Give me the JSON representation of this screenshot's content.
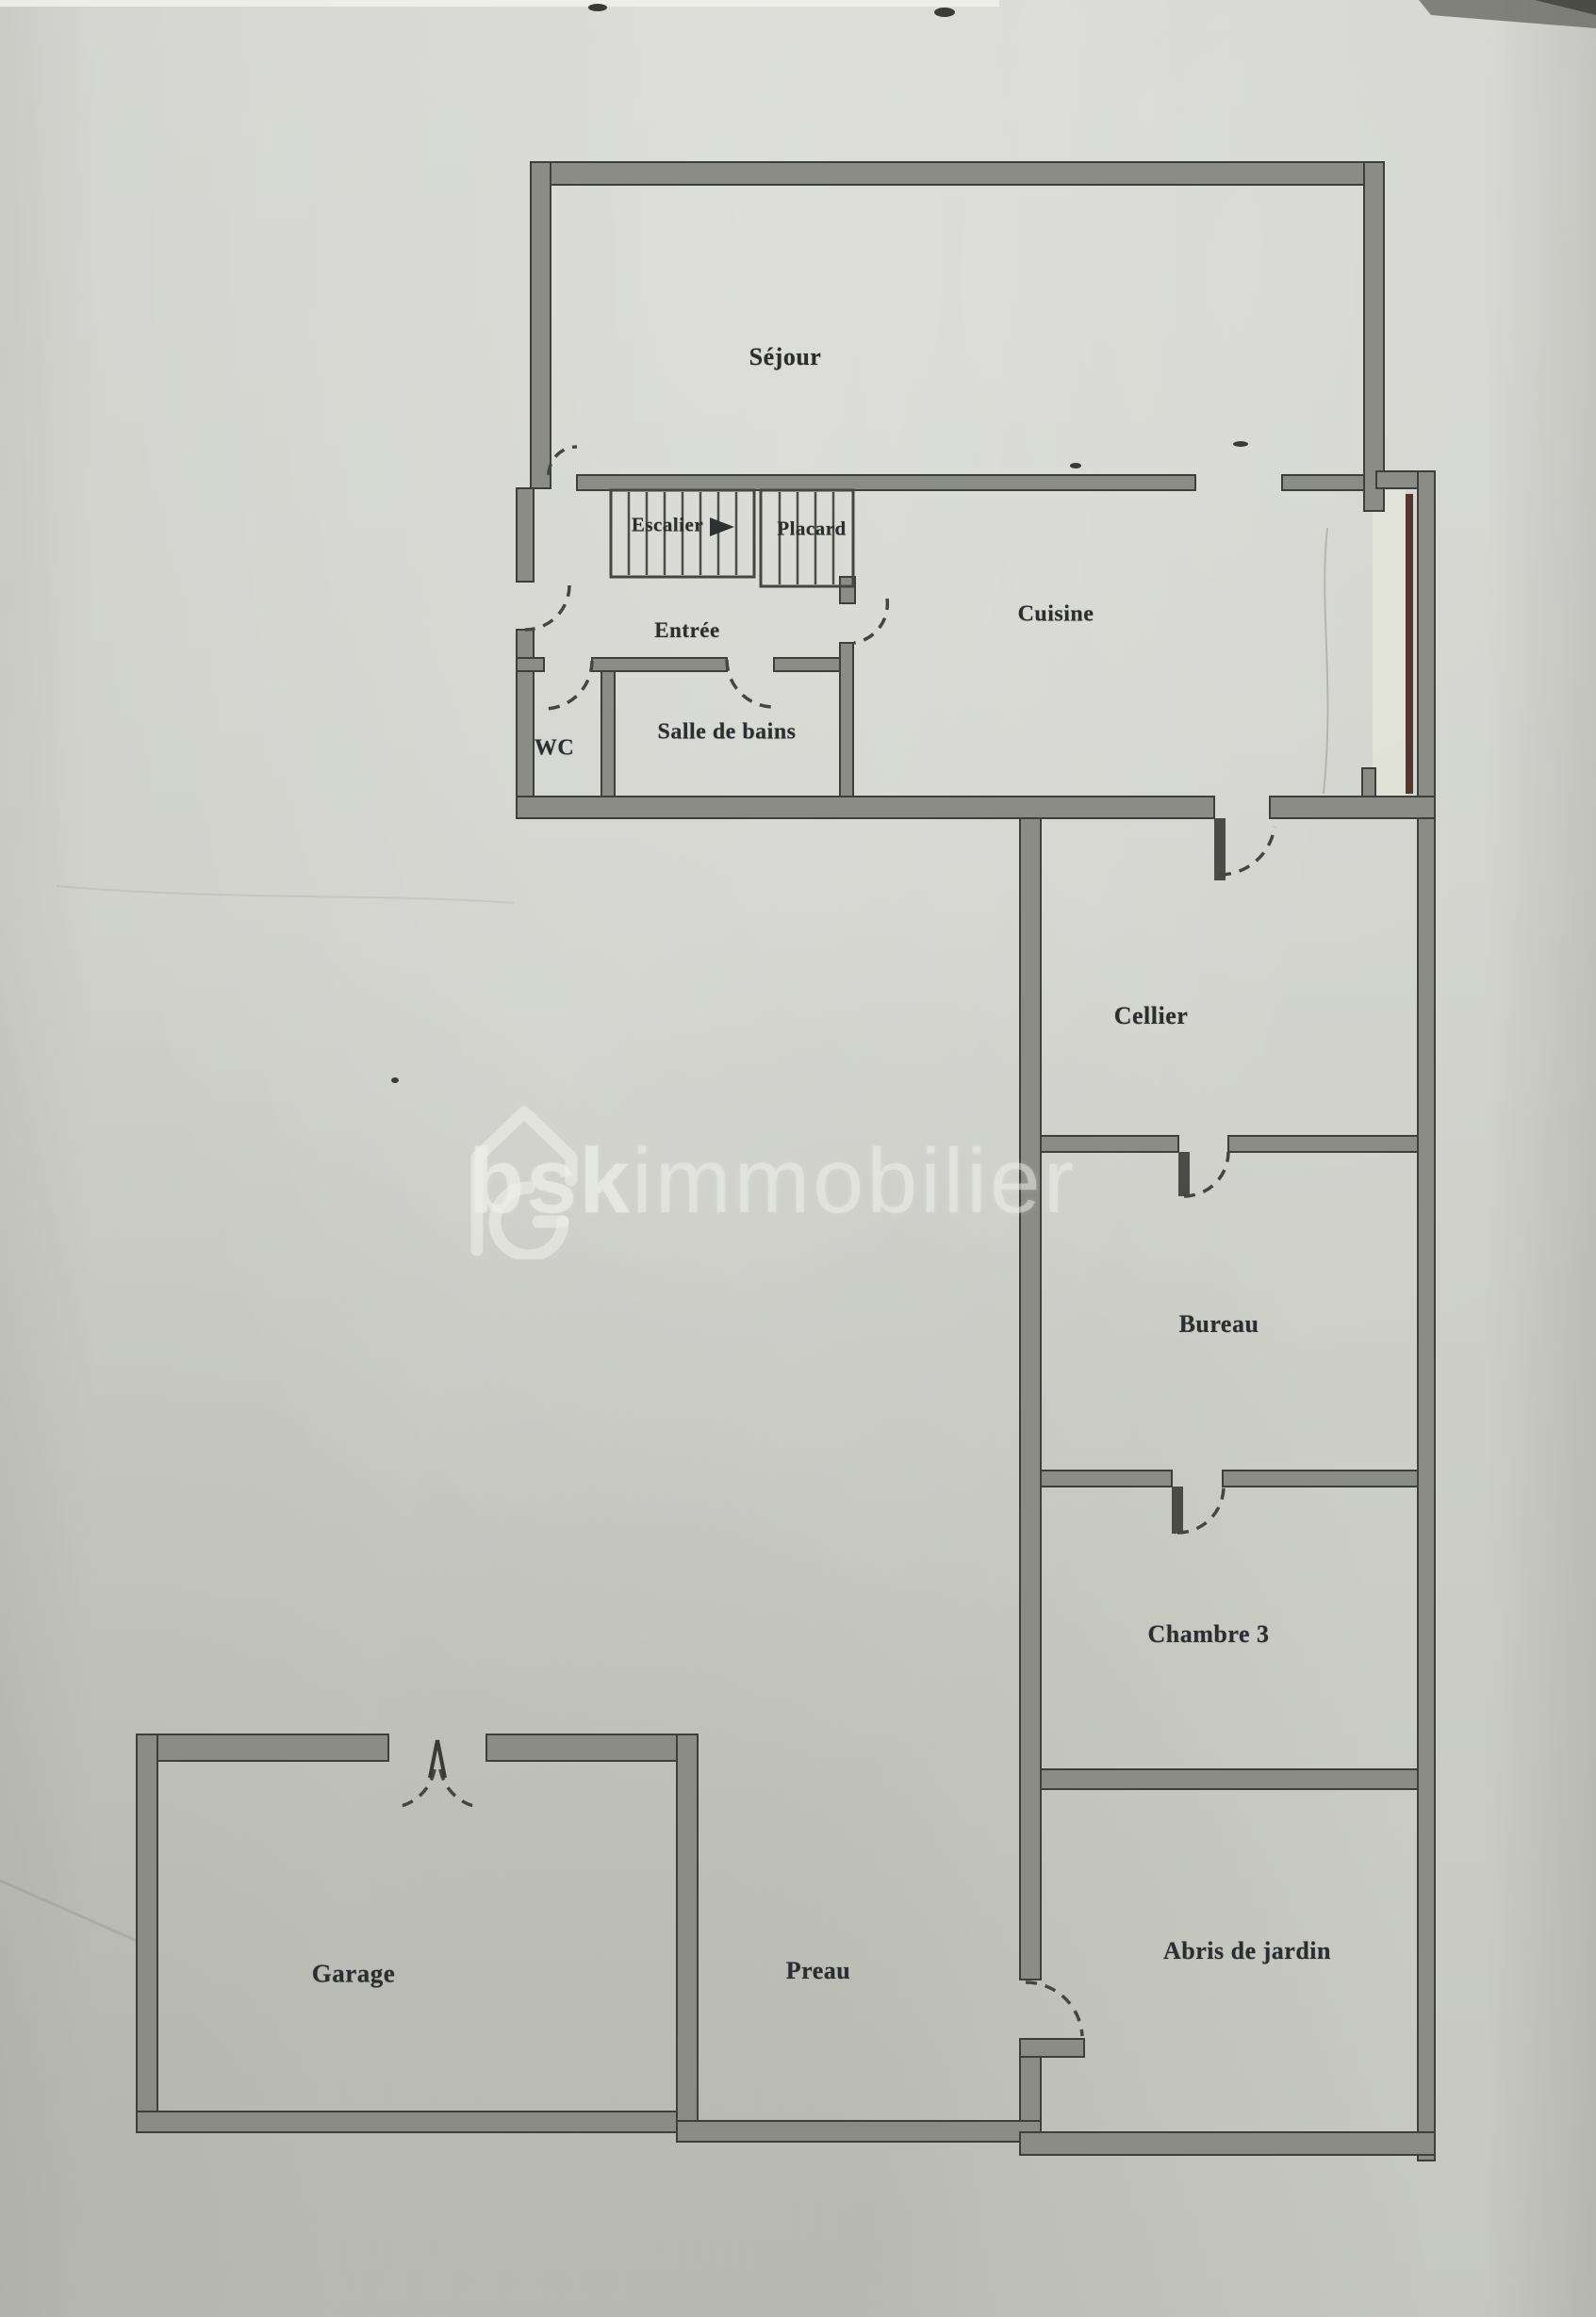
{
  "watermark": {
    "brand_bold": "bsk",
    "brand_light": "immobilier"
  },
  "rooms": {
    "sejour": {
      "label": "Séjour"
    },
    "escalier": {
      "label": "Escalier"
    },
    "placard": {
      "label": "Placard"
    },
    "entree": {
      "label": "Entrée"
    },
    "cuisine": {
      "label": "Cuisine"
    },
    "wc": {
      "label": "WC"
    },
    "salle_de_bains": {
      "label": "Salle de bains"
    },
    "cellier": {
      "label": "Cellier"
    },
    "bureau": {
      "label": "Bureau"
    },
    "chambre3": {
      "label": "Chambre 3"
    },
    "garage": {
      "label": "Garage"
    },
    "preau": {
      "label": "Preau"
    },
    "abris": {
      "label": "Abris de jardin"
    }
  },
  "icons": {
    "watermark_logo": "house-g-logo-icon",
    "stairs_direction": "right-arrow-icon"
  },
  "colors": {
    "paper": "#d1d2cc",
    "wall_fill": "#8b8c86",
    "ink": "#3e3f3a",
    "label_ink": "#2b2d31",
    "glazing": "#53362e",
    "watermark": "#eef1ea"
  }
}
